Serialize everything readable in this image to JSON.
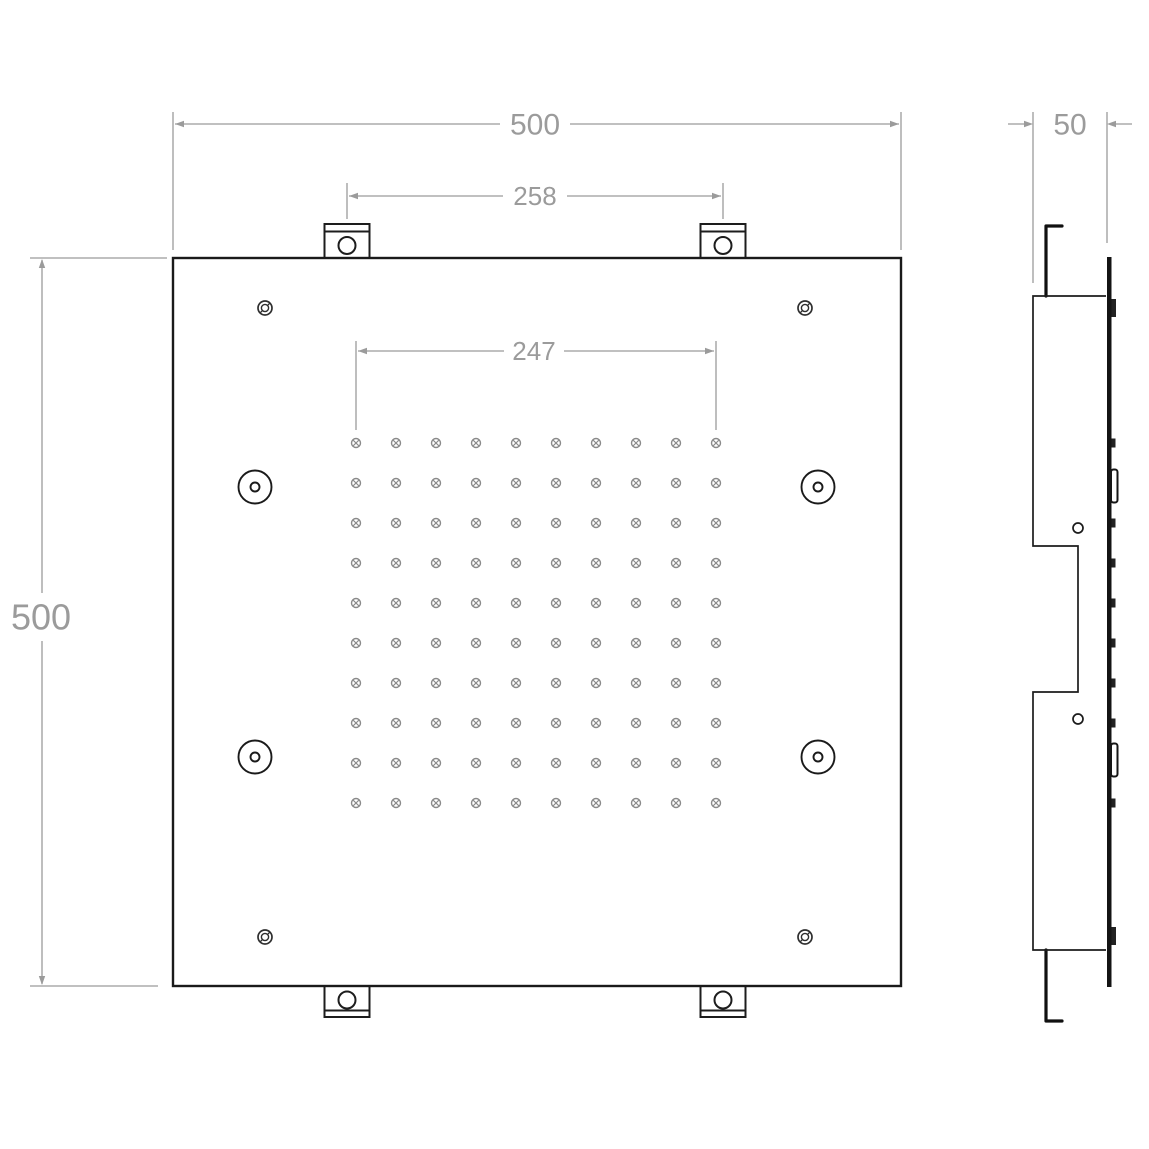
{
  "labels": {
    "front_width": "500",
    "tab_spacing": "258",
    "nozzle_span": "247",
    "front_height": "500",
    "side_depth": "50"
  },
  "colors": {
    "outline": "#1a1a1a",
    "dimension_gray": "#9b9b9b",
    "nozzle_gray": "#8a8a8a",
    "background": "#ffffff"
  },
  "front_view": {
    "panel": {
      "x": 173,
      "y": 258,
      "size": 728
    },
    "nozzle_grid": {
      "cols": 10,
      "rows": 10,
      "x0": 356,
      "y0": 443,
      "step": 40,
      "radius": 4.5
    },
    "leds": [
      [
        255,
        487
      ],
      [
        818,
        487
      ],
      [
        255,
        757
      ],
      [
        818,
        757
      ]
    ],
    "screws": [
      [
        265,
        308
      ],
      [
        805,
        308
      ],
      [
        265,
        937
      ],
      [
        805,
        937
      ]
    ],
    "tabs_top_centers": [
      347,
      723
    ],
    "tabs_bottom_centers": [
      347,
      723
    ]
  },
  "side_view": {
    "nozzle_bump_rows": [
      443,
      523,
      563,
      603,
      643,
      683,
      723,
      803
    ],
    "led_bump_rows": [
      486,
      760
    ],
    "screw_bump_rows": [
      308,
      936
    ]
  }
}
